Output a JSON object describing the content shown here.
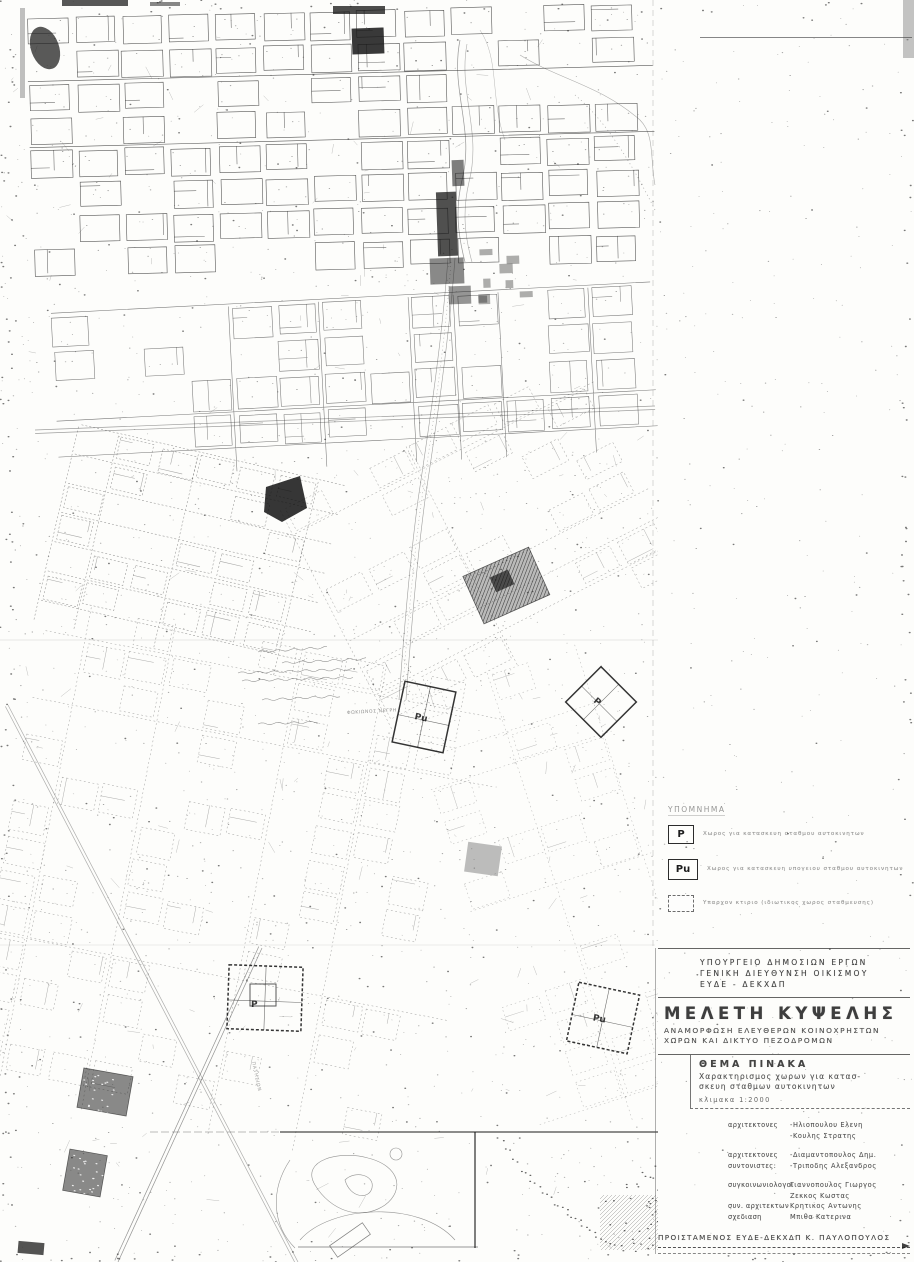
{
  "map": {
    "markers": [
      {
        "label": "Pu"
      },
      {
        "label": "P"
      },
      {
        "label": "P"
      },
      {
        "label": "Pu"
      }
    ],
    "street_labels": [
      {
        "text": "ΦΩΚΙΩΝΟΣ ΝΕΓΡΗ"
      },
      {
        "text": "ΠΑΤΗΣΙΩΝ"
      }
    ]
  },
  "legend": {
    "title": "ΥΠΟΜΝΗΜΑ",
    "items": [
      {
        "symbol": "P",
        "text": "Χωρος για κατασκευη σταθμου αυτοκινητων"
      },
      {
        "symbol": "Pu",
        "text": "Χωρος για κατασκευη υπογειου σταθμου αυτοκινητων"
      },
      {
        "symbol": "",
        "text": "Υπαρχον κτιριο (ιδιωτικος χωρος σταθμευσης)"
      }
    ]
  },
  "title_block": {
    "agency_line1": "ΥΠΟΥΡΓΕΙΟ ΔΗΜΟΣΙΩΝ ΕΡΓΩΝ",
    "agency_line2": "ΓΕΝΙΚΗ ΔΙΕΥΘΥΝΣΗ ΟΙΚΙΣΜΟΥ",
    "agency_line3": "ΕΥΔΕ - ΔΕΚΧΔΠ",
    "study_title": "ΜΕΛΕΤΗ ΚΥΨΕΛΗΣ",
    "study_sub1": "ΑΝΑΜΟΡΦΩΣΗ ΕΛΕΥΘΕΡΩΝ ΚΟΙΝΟΧΡΗΣΤΩΝ",
    "study_sub2": "ΧΩΡΩΝ ΚΑΙ ΔΙΚΤΥΟ ΠΕΖΟΔΡΟΜΩΝ",
    "sheet_heading": "ΘΕΜΑ ΠΙΝΑΚΑ",
    "sheet_subject1": "Χαρακτηρισμος χωρων για κατασ-",
    "sheet_subject2": "σκευη σταθμων αυτοκινητων",
    "scale": "κλιμακα 1:2000",
    "credits": [
      {
        "role": "αρχιτεκτονες",
        "name": "-Ηλιοπουλου Ελενη"
      },
      {
        "role": "",
        "name": "-Κουλης Στρατης"
      },
      {
        "role": "αρχιτεκτονες",
        "name": "-Διαμαντοπουλος Δημ."
      },
      {
        "role": "συντονιστες:",
        "name": "-Τριποδης Αλεξανδρος"
      },
      {
        "role": "συγκοινωνιολογοι",
        "name": "Γιαννοπουλος Γιωργος"
      },
      {
        "role": "",
        "name": "Ζεκκος Κωστας"
      },
      {
        "role": "συν. αρχιτεκτων",
        "name": "Κρητικος Αντωνης"
      },
      {
        "role": "σχεδιαση",
        "name": "Μπιθα Κατερινα"
      }
    ],
    "supervisor": "ΠΡΟΙΣΤΑΜΕΝΟΣ ΕΥΔΕ-ΔΕΚΧΔΠ   Κ. ΠΑΥΛΟΠΟΥΛΟΣ"
  }
}
